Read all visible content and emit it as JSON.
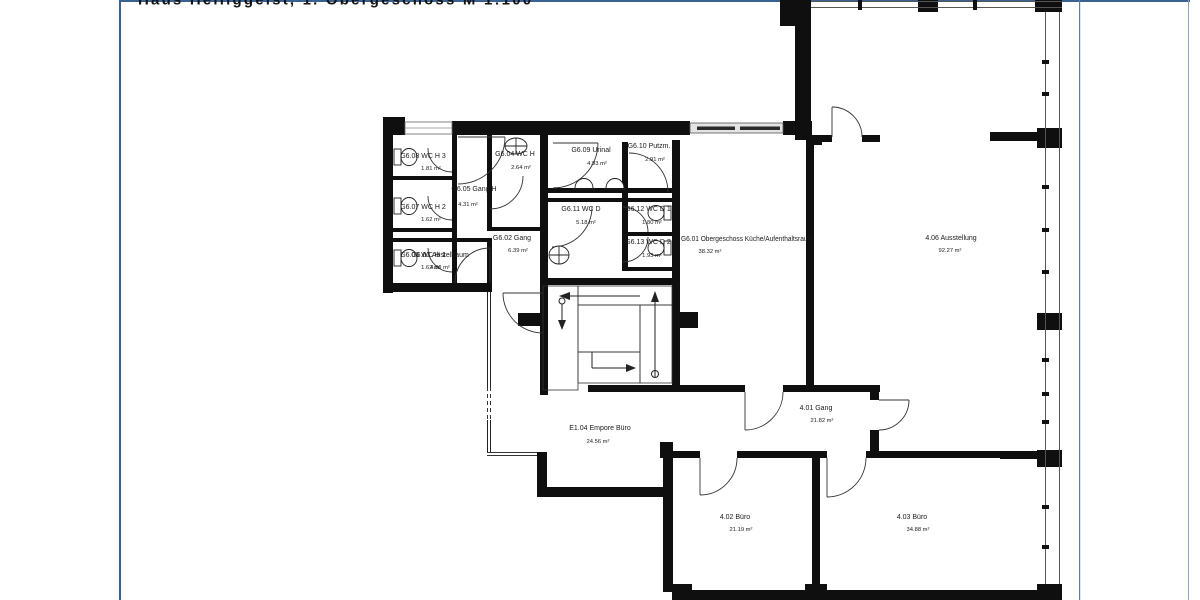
{
  "header": {
    "title_clipped": "Haus Heiliggeist, 1. Obergeschoss      M 1:100"
  },
  "colors": {
    "frame_blue": "#3a6191",
    "wall_black": "#0f0f0f",
    "window_gray": "#e3e3e3"
  },
  "rooms": [
    {
      "id": "G6.08",
      "label": "G6.08 WC H 3",
      "area": "1.81 m²"
    },
    {
      "id": "G6.07",
      "label": "G6.07 WC H 2",
      "area": "1.62 m²"
    },
    {
      "id": "G6.06",
      "label": "G6.06 WC H 1",
      "area": "1.62 m²"
    },
    {
      "id": "G6.05",
      "label": "G6.05 Gang H",
      "area": "4.31 m²"
    },
    {
      "id": "G6.04",
      "label": "G6.04 WC H",
      "area": "2.64 m²"
    },
    {
      "id": "G6.09",
      "label": "G6.09 Urinal",
      "area": "4.93 m²"
    },
    {
      "id": "G6.10",
      "label": "G6.10 Putzm.",
      "area": "2.91 m²"
    },
    {
      "id": "G6.11",
      "label": "G6.11 WC D",
      "area": "5.18 m²"
    },
    {
      "id": "G6.12",
      "label": "G6.12 WC D 1",
      "area": "1.80 m²"
    },
    {
      "id": "G6.13",
      "label": "G6.13 WC D 2",
      "area": "1.93 m²"
    },
    {
      "id": "G6.03",
      "label": "G6.03 Abstellraum",
      "area": "4.86 m²"
    },
    {
      "id": "G6.02",
      "label": "G6.02 Gang",
      "area": "6.39 m²"
    },
    {
      "id": "G6.01",
      "label": "G6.01 Obergeschoss Küche/Aufenthaltsraum",
      "area": "38.32 m²"
    },
    {
      "id": "4.06",
      "label": "4.06  Ausstellung",
      "area": "92.27 m²"
    },
    {
      "id": "E1.04",
      "label": "E1.04 Empore Büro",
      "area": "24.56 m²"
    },
    {
      "id": "4.01",
      "label": "4.01  Gang",
      "area": "21.82 m²"
    },
    {
      "id": "4.02",
      "label": "4.02  Büro",
      "area": "21.19 m²"
    },
    {
      "id": "4.03",
      "label": "4.03  Büro",
      "area": "34.88 m²"
    }
  ]
}
